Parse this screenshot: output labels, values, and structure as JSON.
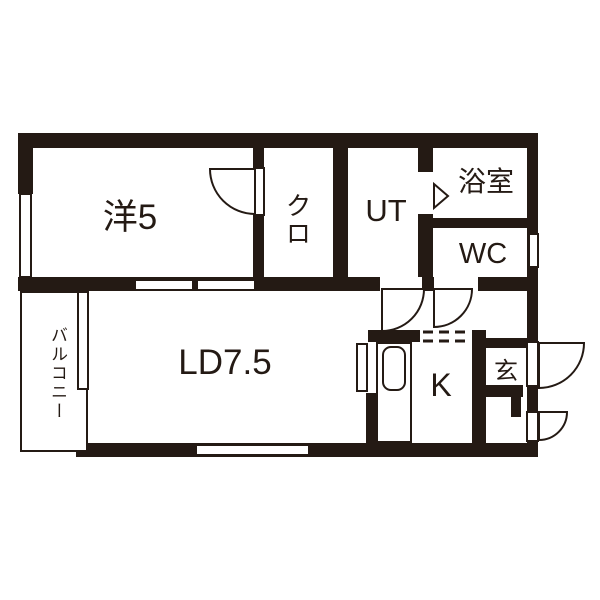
{
  "plan_title": "1LDK apartment floor plan",
  "rooms": {
    "western": {
      "label": "洋5",
      "meaning": "western-style room 5 tatami"
    },
    "closet": {
      "label": "クロ",
      "meaning": "closet"
    },
    "utility": {
      "label": "UT",
      "meaning": "utility"
    },
    "bathroom": {
      "label": "浴室",
      "meaning": "bath room"
    },
    "toilet": {
      "label": "WC",
      "meaning": "toilet"
    },
    "balcony": {
      "label": "バルコニー",
      "meaning": "balcony"
    },
    "living_dining": {
      "label": "LD7.5",
      "meaning": "living dining 7.5 tatami"
    },
    "kitchen": {
      "label": "K",
      "meaning": "kitchen"
    },
    "entrance": {
      "label": "玄",
      "meaning": "entrance (genkan)"
    }
  },
  "fixtures": [
    "closet-swing-door",
    "utility-swing-door",
    "toilet-swing-door",
    "bath-folding-door",
    "entrance-swing-door",
    "lower-swing-door",
    "kitchen-counter",
    "kitchen-sink",
    "open-boundary-dashed",
    "window-west",
    "window-wc",
    "sliding-partition",
    "window-ld-south",
    "balcony-window"
  ],
  "colors": {
    "wall": "#241a14",
    "floor": "#ffffff",
    "line": "#241a14"
  }
}
